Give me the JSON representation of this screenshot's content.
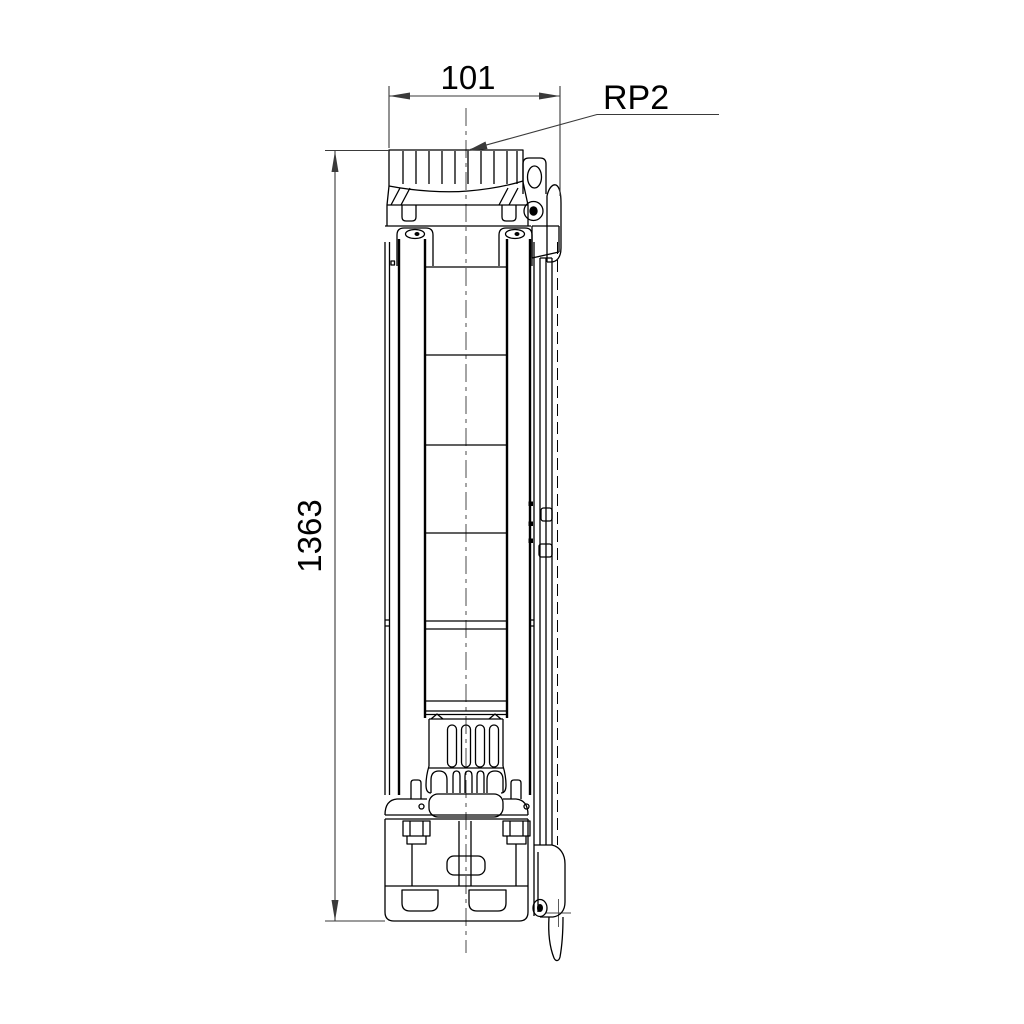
{
  "drawing": {
    "colors": {
      "object_line": "#000000",
      "dimension_line": "#3a3a3a",
      "centerline": "#4a4a4a",
      "text": "#000000"
    },
    "dimensions": [
      {
        "id": "overall-width",
        "value": "101",
        "orientation": "horizontal",
        "position": "top"
      },
      {
        "id": "overall-height",
        "value": "1363",
        "orientation": "vertical",
        "position": "left"
      }
    ],
    "callouts": [
      {
        "id": "discharge-thread",
        "label": "RP2"
      }
    ]
  }
}
